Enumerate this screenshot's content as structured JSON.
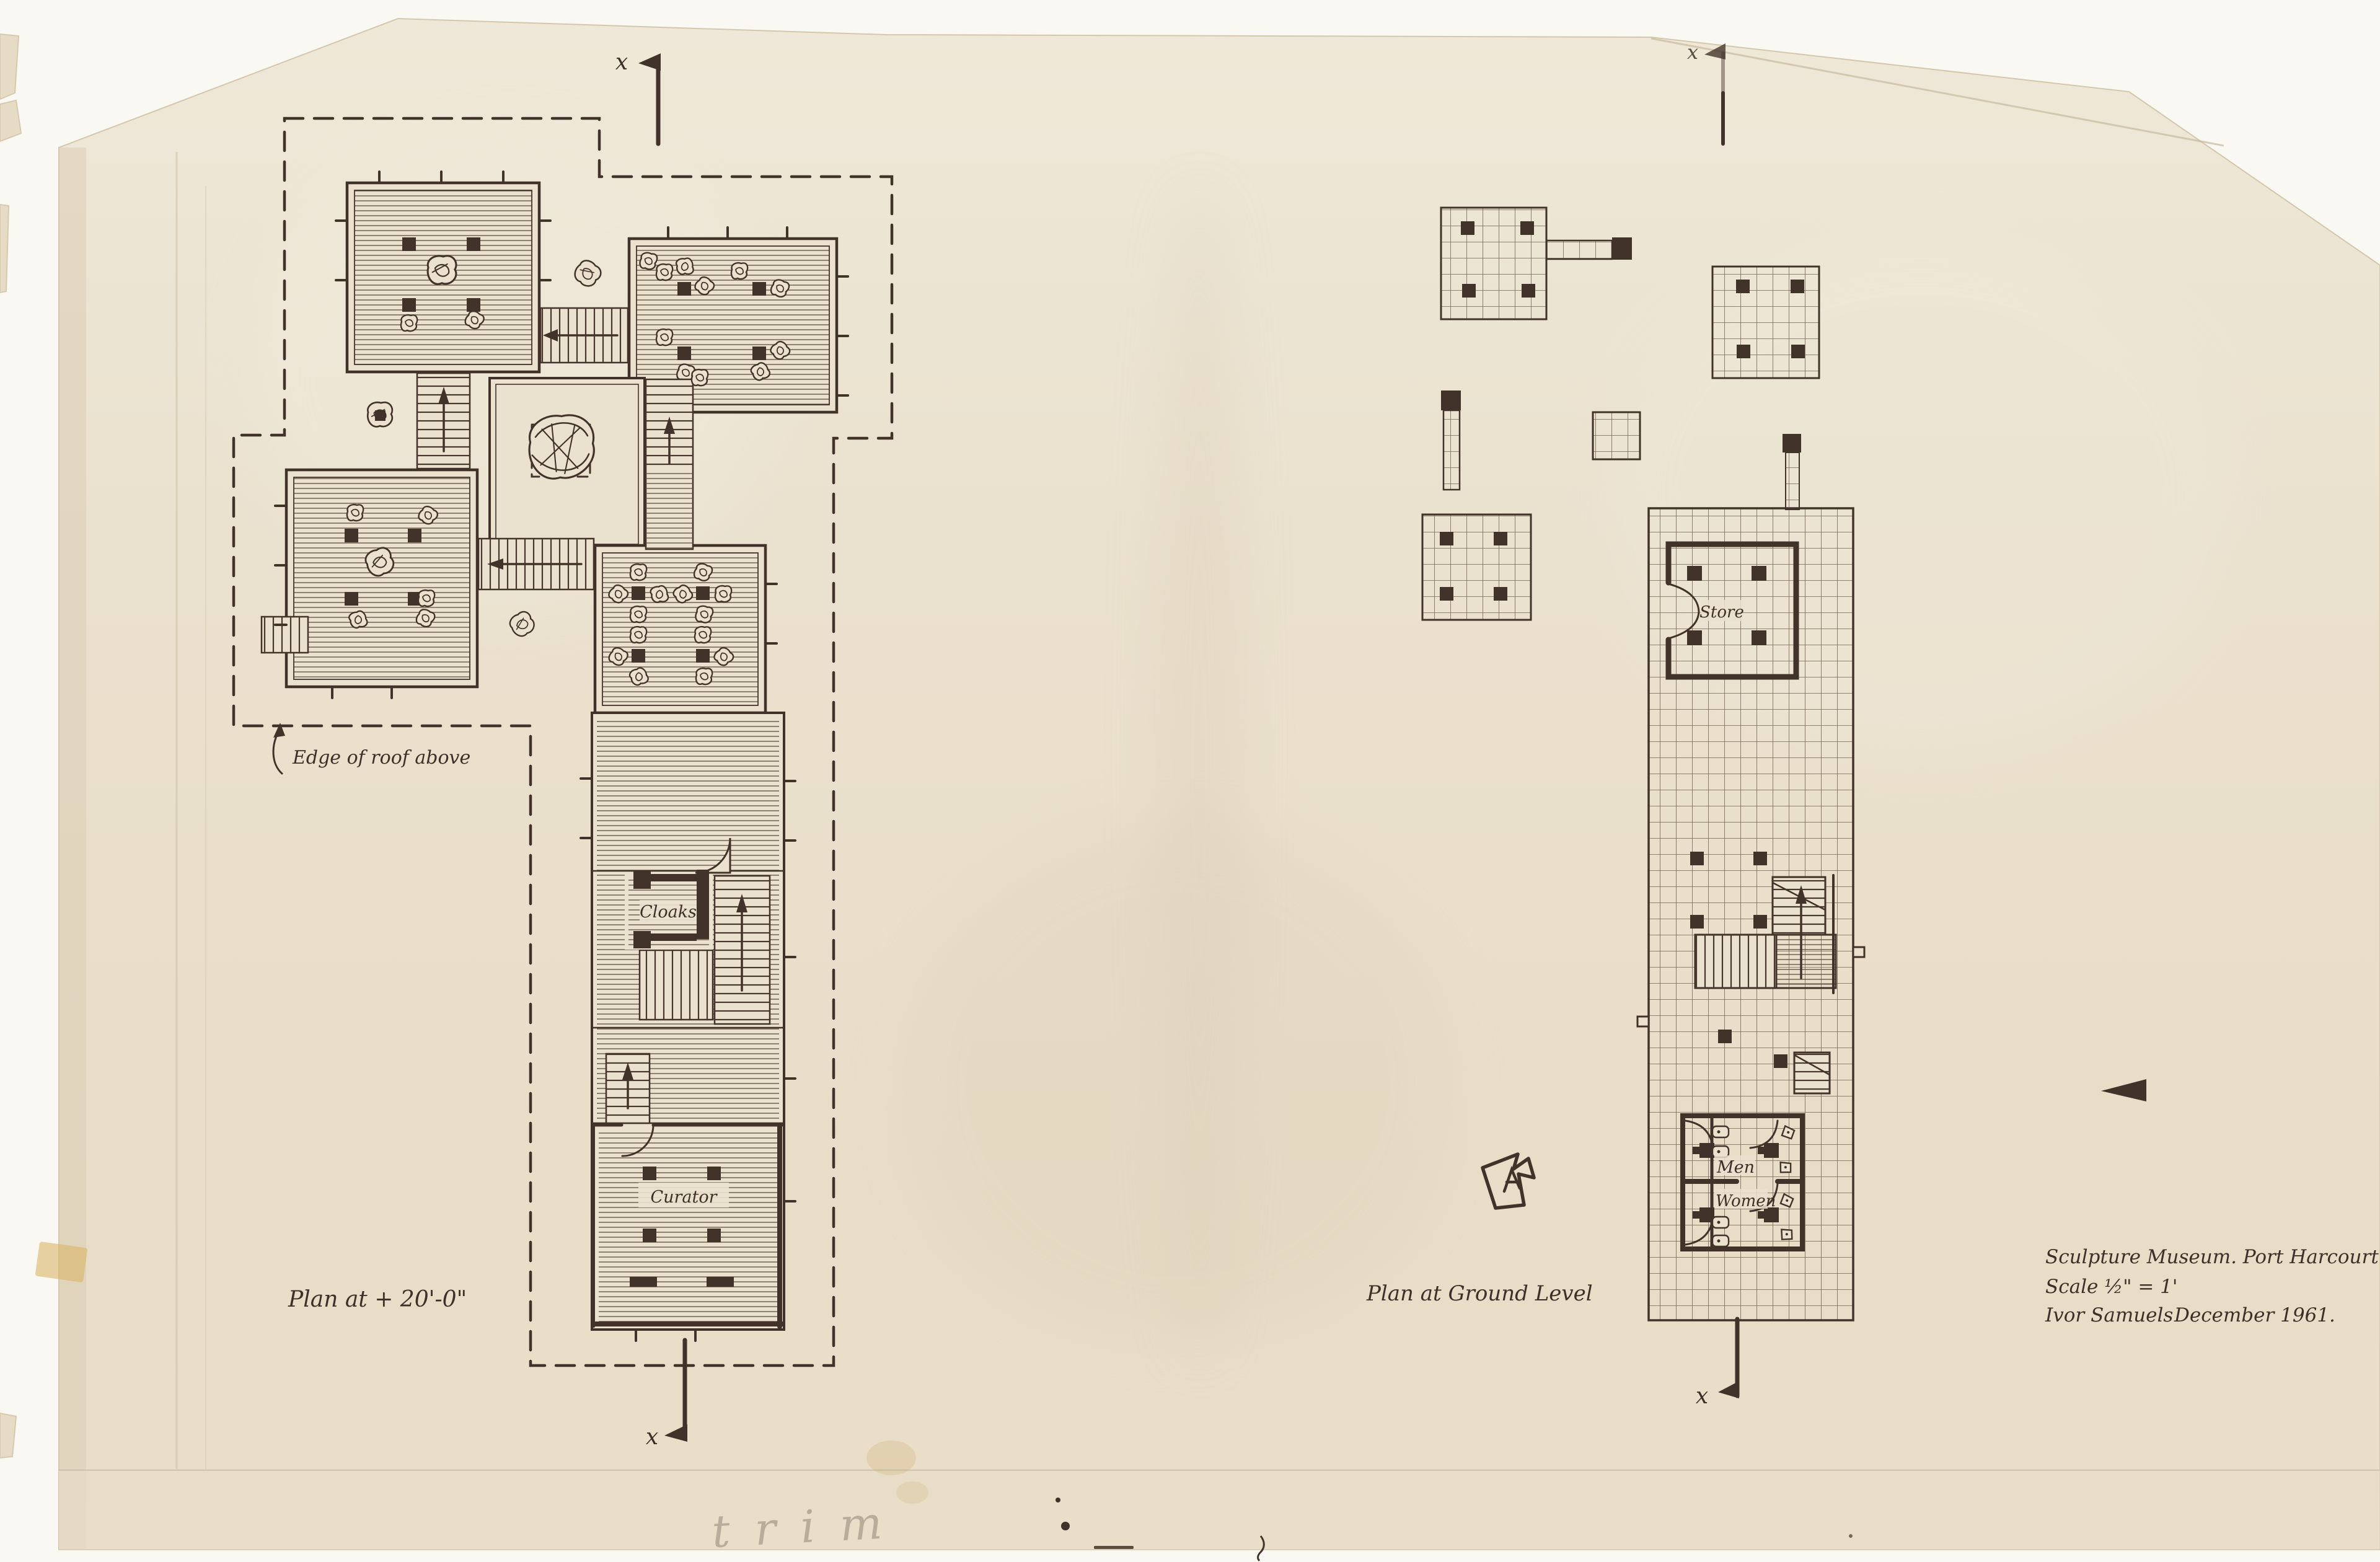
{
  "sheet": {
    "title_block": {
      "project": "Sculpture Museum. Port Harcourt",
      "scale": "Scale ½\" = 1'",
      "architect": "Ivor Samuels",
      "date": "December 1961."
    },
    "pencil_note": "trim"
  },
  "left_plan": {
    "caption": "Plan at + 20'-0\"",
    "roof_note": "Edge of roof above",
    "room_cloaks": "Cloaks",
    "room_curator": "Curator",
    "section_marker": "x"
  },
  "right_plan": {
    "caption": "Plan at Ground Level",
    "room_store": "Store",
    "room_men": "Men",
    "room_women": "Women",
    "section_marker": "x"
  },
  "colors": {
    "paper": "#e9e0cc",
    "paper_light": "#efe8d9",
    "ink": "#42332a",
    "hatch": "#5d4a3a",
    "background": "#f9f8f3",
    "tape": "#d9b568"
  }
}
